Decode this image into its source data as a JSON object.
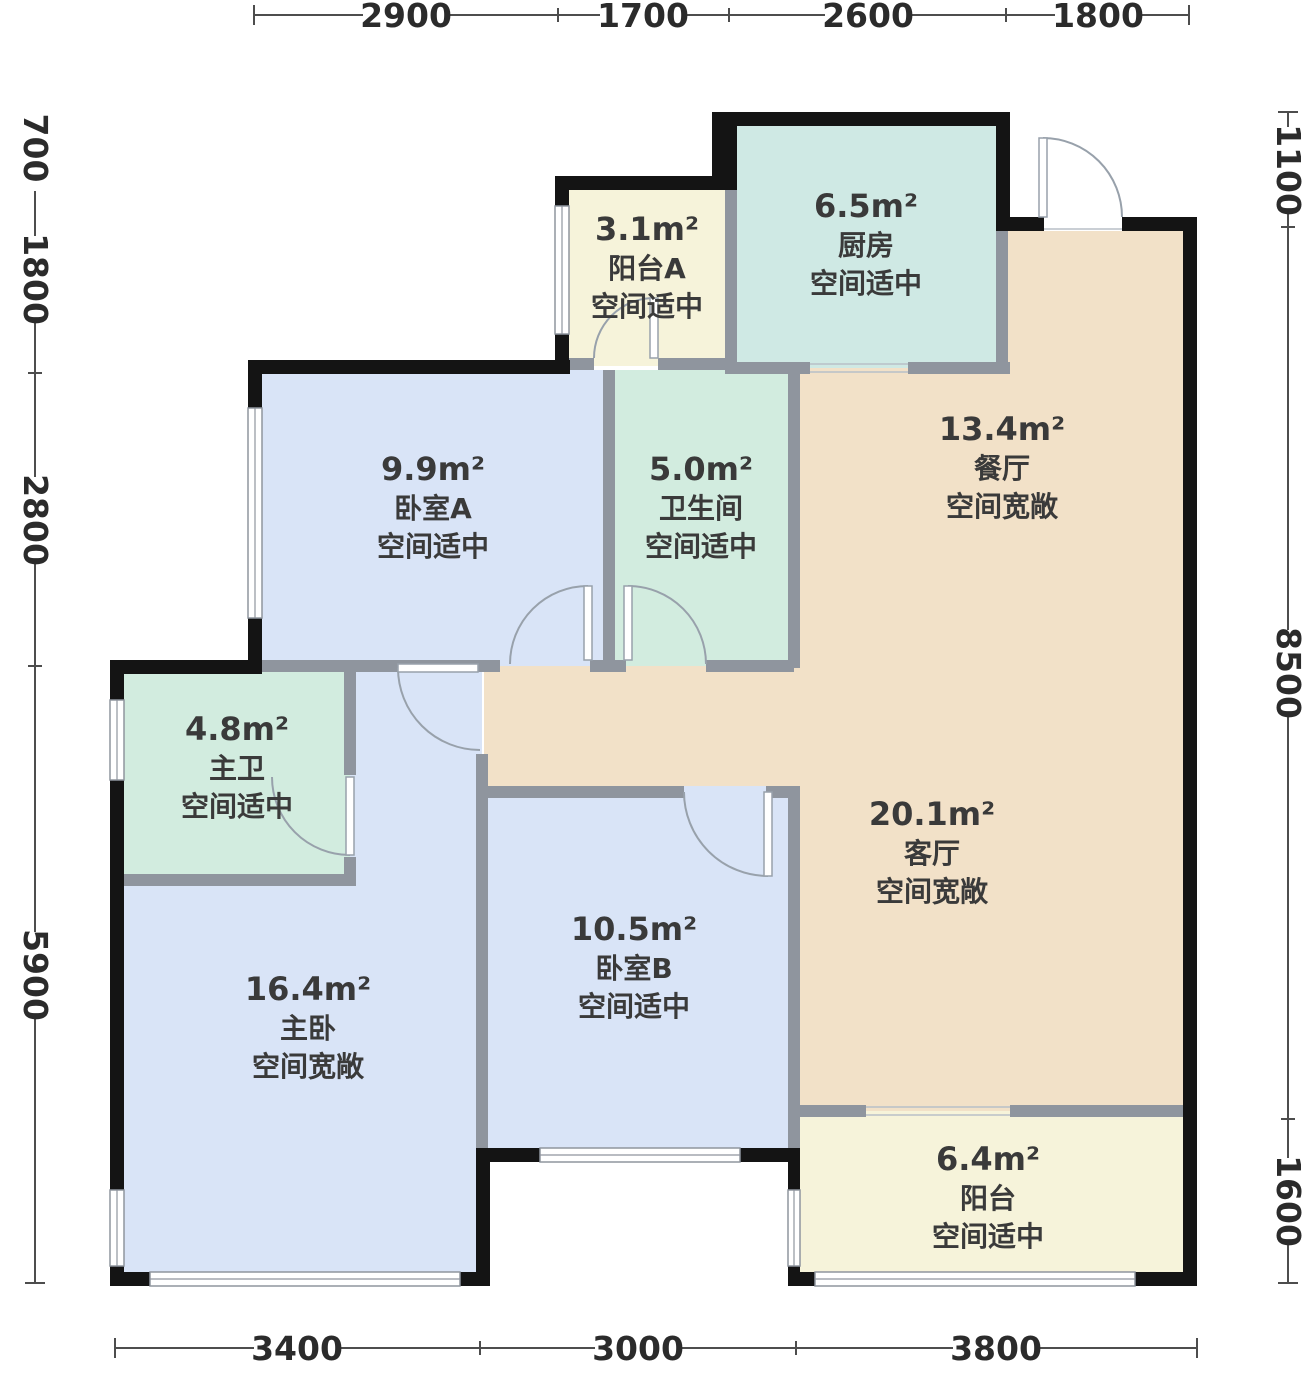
{
  "plan": {
    "title": "户型图",
    "rooms": [
      {
        "id": "balcony-a",
        "area": "3.1m²",
        "name": "阳台A",
        "note": "空间适中",
        "fill_key": "balcony"
      },
      {
        "id": "kitchen",
        "area": "6.5m²",
        "name": "厨房",
        "note": "空间适中",
        "fill_key": "kitchen"
      },
      {
        "id": "dining",
        "area": "13.4m²",
        "name": "餐厅",
        "note": "空间宽敞",
        "fill_key": "living"
      },
      {
        "id": "bedroom-a",
        "area": "9.9m²",
        "name": "卧室A",
        "note": "空间适中",
        "fill_key": "bedroom"
      },
      {
        "id": "bathroom",
        "area": "5.0m²",
        "name": "卫生间",
        "note": "空间适中",
        "fill_key": "bath"
      },
      {
        "id": "master-bath",
        "area": "4.8m²",
        "name": "主卫",
        "note": "空间适中",
        "fill_key": "bath"
      },
      {
        "id": "living",
        "area": "20.1m²",
        "name": "客厅",
        "note": "空间宽敞",
        "fill_key": "living"
      },
      {
        "id": "bedroom-b",
        "area": "10.5m²",
        "name": "卧室B",
        "note": "空间适中",
        "fill_key": "bedroom"
      },
      {
        "id": "master-bedroom",
        "area": "16.4m²",
        "name": "主卧",
        "note": "空间宽敞",
        "fill_key": "bedroom"
      },
      {
        "id": "balcony",
        "area": "6.4m²",
        "name": "阳台",
        "note": "空间适中",
        "fill_key": "balcony"
      }
    ],
    "dimensions": {
      "top": [
        "2900",
        "1700",
        "2600",
        "1800"
      ],
      "left": [
        "700",
        "1800",
        "2800",
        "5900"
      ],
      "right": [
        "1100",
        "8500",
        "1600"
      ],
      "bottom": [
        "3400",
        "3000",
        "3800"
      ]
    },
    "colors": {
      "bedroom": "#d9e4f7",
      "bath": "#d2ecdf",
      "kitchen": "#cfe9e4",
      "living": "#f2e1c8",
      "balcony": "#f6f3da",
      "wall_exterior": "#141414",
      "wall_interior": "#8f959e"
    }
  }
}
